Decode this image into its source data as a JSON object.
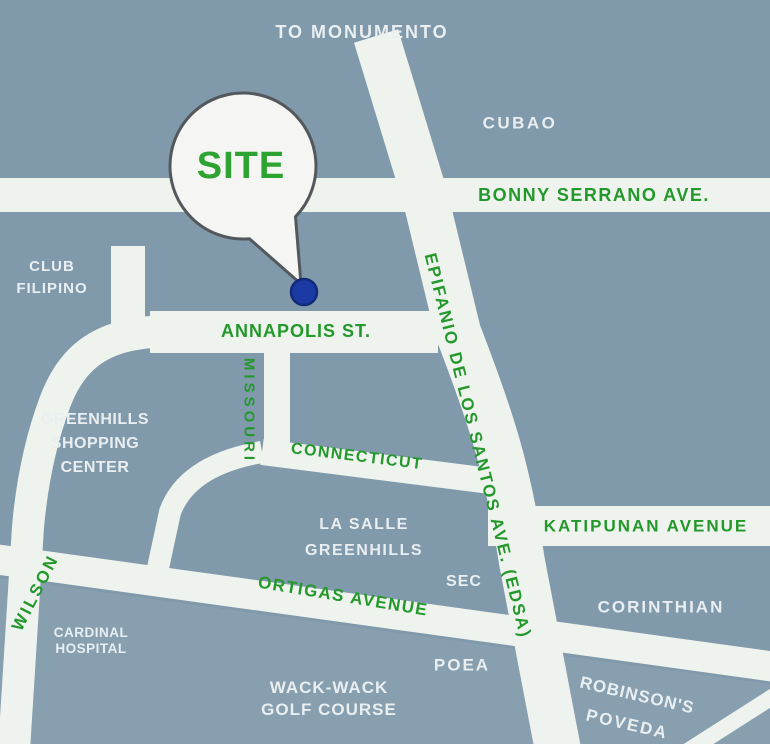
{
  "map": {
    "type": "vicinity-location-map",
    "site_balloon": {
      "label": "SITE"
    },
    "colors": {
      "background": "#8099AB",
      "road": "#EFF3EE",
      "street_label_green": "#23982B",
      "site_label_green": "#2DA431",
      "place_label_white": "#E9EEF1",
      "site_marker_blue": "#1B3AA4",
      "balloon_border_gray": "#53585C"
    },
    "labels": {
      "to_monumento": "TO MONUMENTO",
      "cubao": "CUBAO",
      "bonny_serrano": "BONNY SERRANO AVE.",
      "club_filipino": {
        "line1": "CLUB",
        "line2": "FILIPINO"
      },
      "annapolis": "ANNAPOLIS ST.",
      "missouri": "MISSOURI",
      "connecticut": "CONNECTICUT",
      "greenhills_sc": {
        "line1": "GREENHILLS",
        "line2": "SHOPPING",
        "line3": "CENTER"
      },
      "edsa": "EPIFANIO DE LOS SANTOS AVE. (EDSA)",
      "la_salle": {
        "line1": "LA SALLE",
        "line2": "GREENHILLS"
      },
      "katipunan": "KATIPUNAN AVENUE",
      "sec": "SEC",
      "ortigas": "ORTIGAS AVENUE",
      "corinthian": "CORINTHIAN",
      "wilson": "WILSON",
      "cardinal_hospital": {
        "line1": "CARDINAL",
        "line2": "HOSPITAL"
      },
      "poea": "POEA",
      "wack_wack": {
        "line1": "WACK-WACK",
        "line2": "GOLF COURSE"
      },
      "robinsons_poveda": {
        "line1": "ROBINSON'S",
        "line2": "POVEDA"
      }
    }
  }
}
